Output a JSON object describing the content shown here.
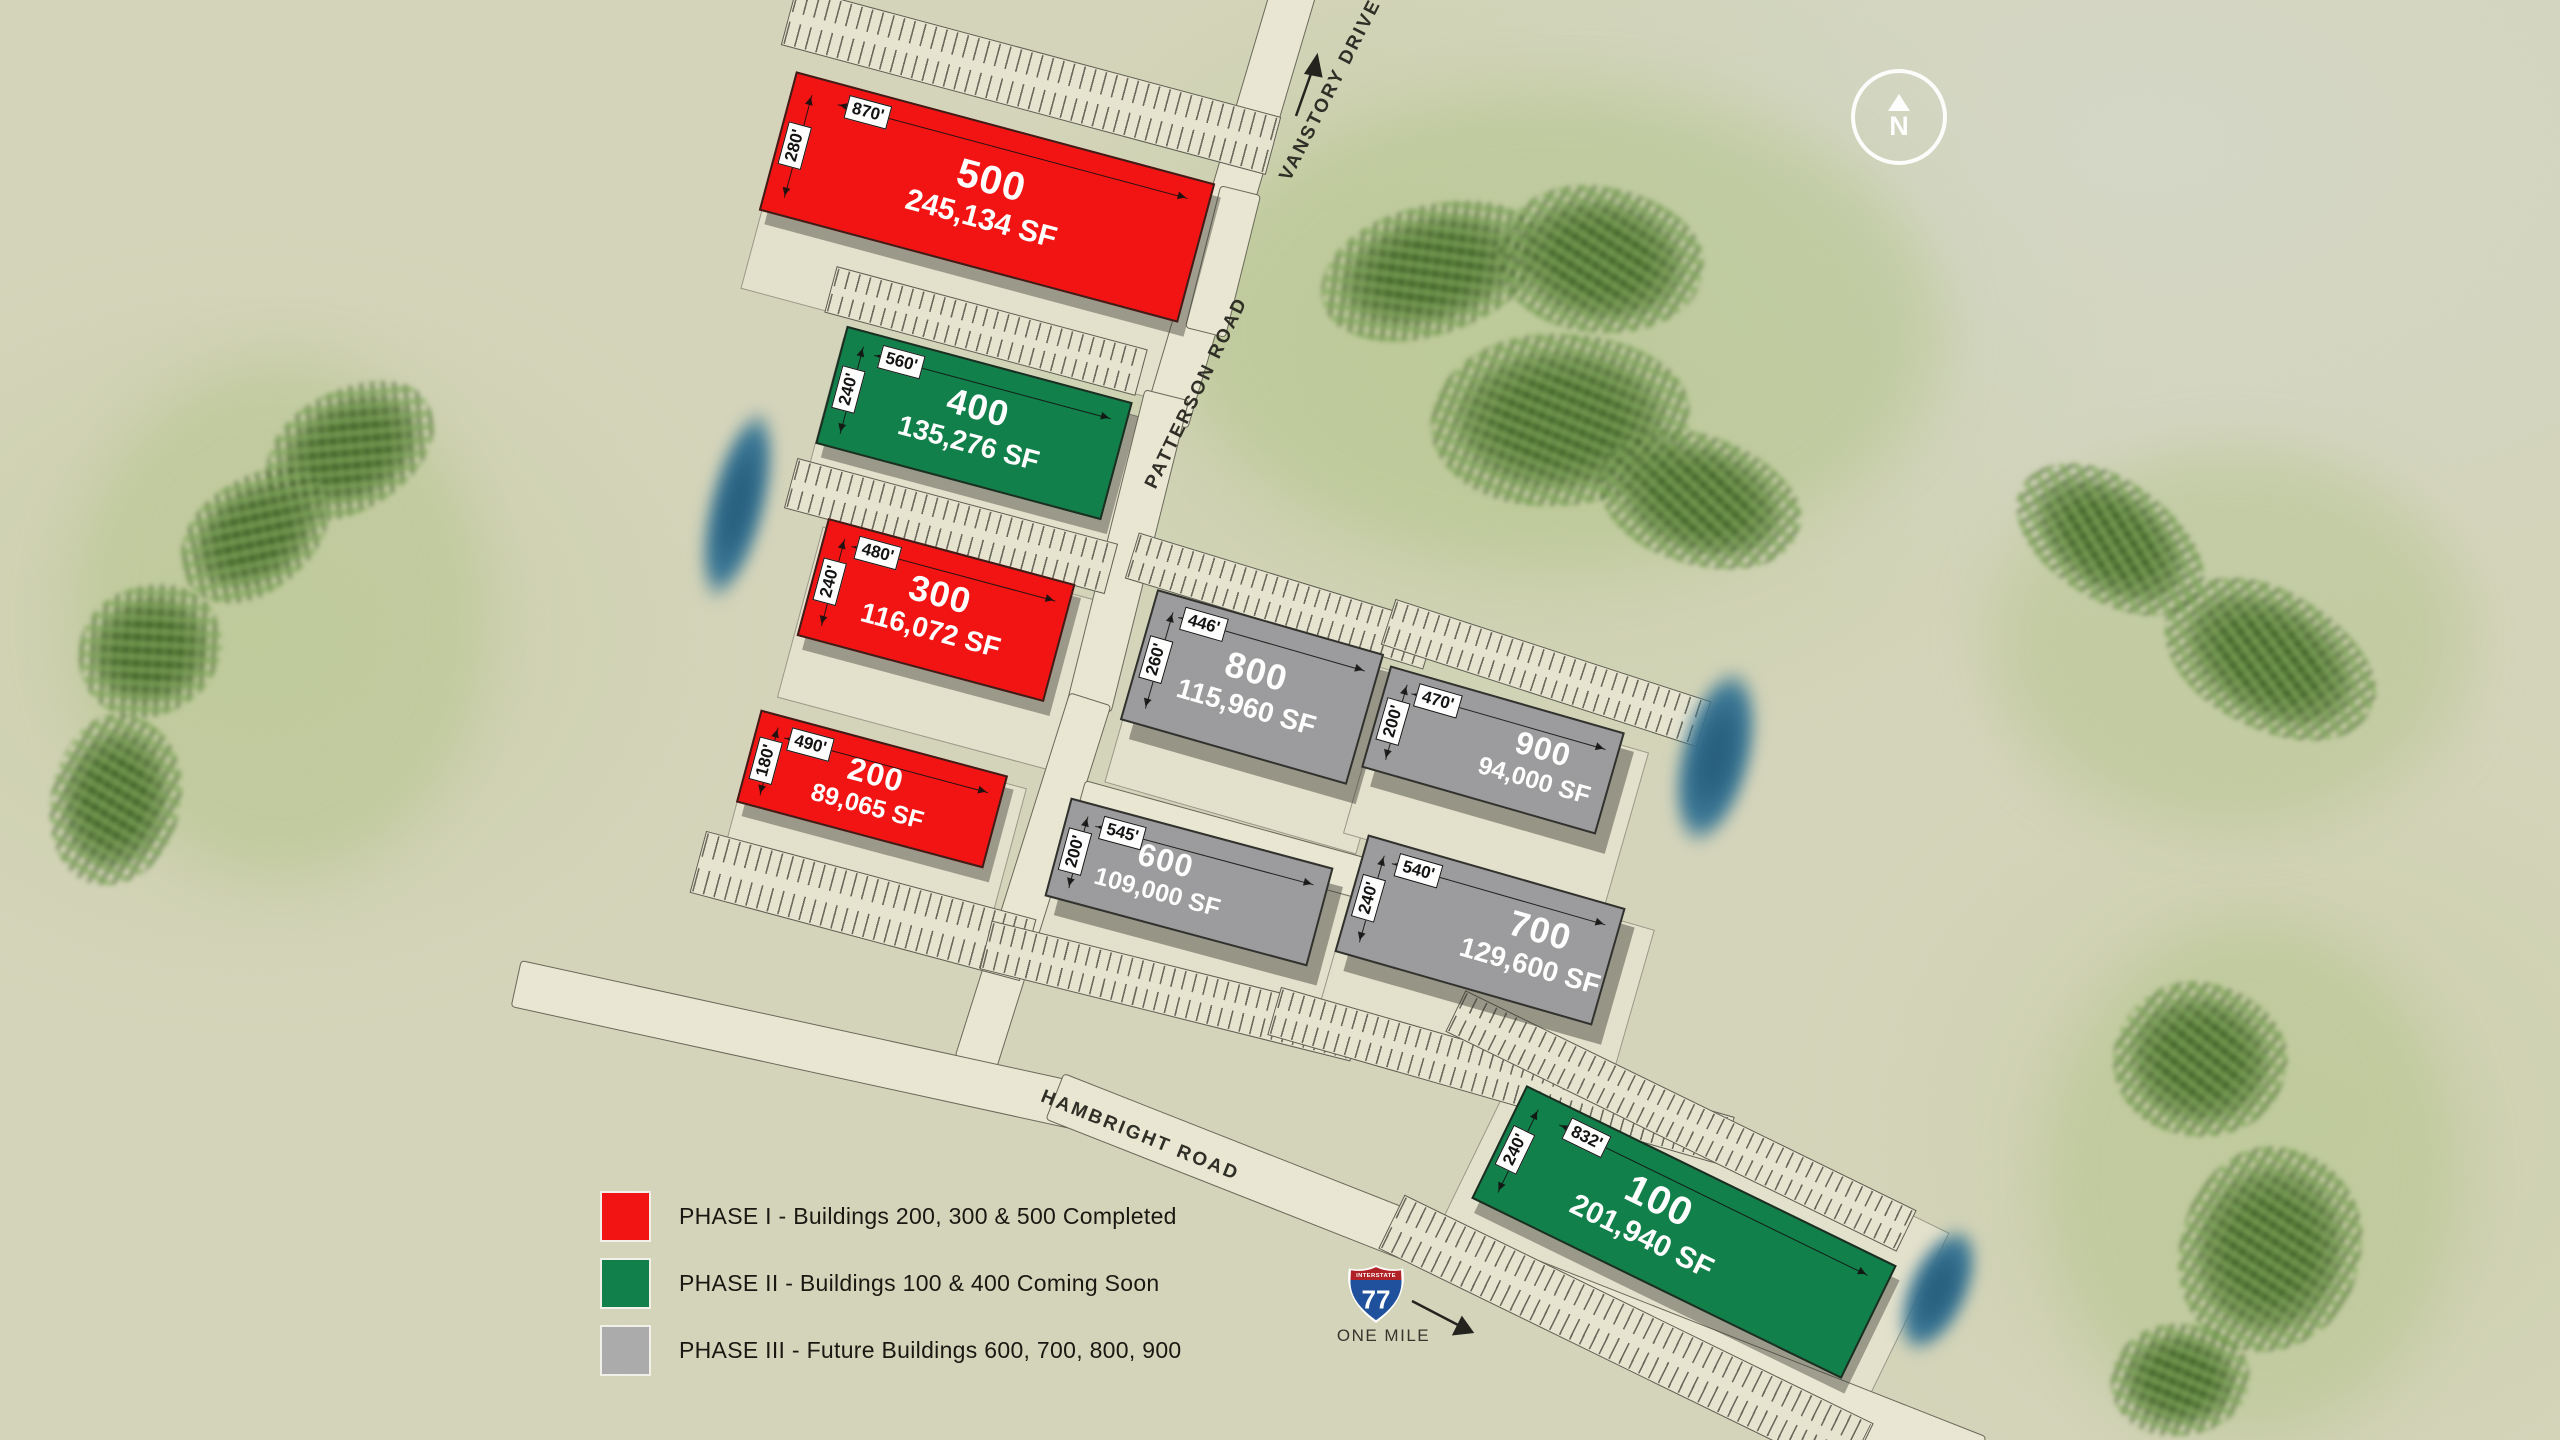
{
  "map": {
    "compass_label": "N"
  },
  "roads": {
    "vanstory": "VANSTORY DRIVE",
    "patterson": "PATTERSON ROAD",
    "hambright": "HAMBRIGHT ROAD"
  },
  "highway": {
    "interstate_label": "INTERSTATE",
    "route_number": "77",
    "distance_label": "ONE MILE"
  },
  "legend": {
    "items": [
      {
        "phase": "PHASE I",
        "label": "PHASE I - Buildings 200, 300 & 500 Completed",
        "color": "#f31111"
      },
      {
        "phase": "PHASE II",
        "label": "PHASE II - Buildings 100 & 400 Coming Soon",
        "color": "#0f7f49"
      },
      {
        "phase": "PHASE III",
        "label": "PHASE III - Future Buildings 600, 700, 800, 900",
        "color": "#ababad"
      }
    ]
  },
  "buildings": {
    "b500": {
      "number": "500",
      "sf": "245,134 SF",
      "length": "870'",
      "width": "280'",
      "phase": "PHASE I"
    },
    "b400": {
      "number": "400",
      "sf": "135,276 SF",
      "length": "560'",
      "width": "240'",
      "phase": "PHASE II"
    },
    "b300": {
      "number": "300",
      "sf": "116,072 SF",
      "length": "480'",
      "width": "240'",
      "phase": "PHASE I"
    },
    "b200": {
      "number": "200",
      "sf": "89,065 SF",
      "length": "490'",
      "width": "180'",
      "phase": "PHASE I"
    },
    "b800": {
      "number": "800",
      "sf": "115,960 SF",
      "length": "446'",
      "width": "260'",
      "phase": "PHASE III"
    },
    "b900": {
      "number": "900",
      "sf": "94,000 SF",
      "length": "470'",
      "width": "200'",
      "phase": "PHASE III"
    },
    "b600": {
      "number": "600",
      "sf": "109,000 SF",
      "length": "545'",
      "width": "200'",
      "phase": "PHASE III"
    },
    "b700": {
      "number": "700",
      "sf": "129,600 SF",
      "length": "540'",
      "width": "240'",
      "phase": "PHASE III"
    },
    "b100": {
      "number": "100",
      "sf": "201,940 SF",
      "length": "832'",
      "width": "240'",
      "phase": "PHASE II"
    }
  },
  "colors": {
    "phase_1": "#f31111",
    "phase_2": "#0f7f49",
    "phase_3": "#9c9b9d",
    "water": "#35708e",
    "road": "#eae8d3",
    "background": "#d5d5bb",
    "shield_red": "#b01f24",
    "shield_blue": "#1d4f9c"
  }
}
